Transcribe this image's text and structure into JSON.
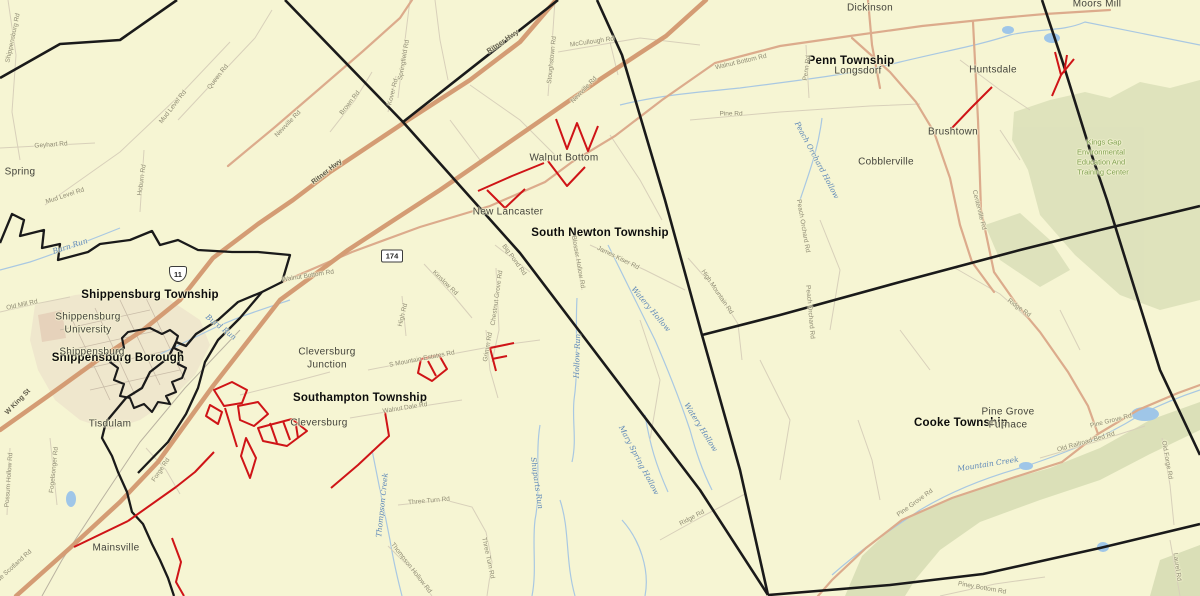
{
  "map": {
    "colors": {
      "background": "#f6f5d3",
      "boundary": "#1a1a1a",
      "highway_major": "#d49c74",
      "highway_secondary": "#dcab8c",
      "minor_road": "#d8d0ba",
      "red_highlight": "#cf1417",
      "stream": "#a9c8e2",
      "pond": "#9fc6e8",
      "forest_fill": "#dde1bb",
      "urban_fill": "#eadbc8",
      "township_text": "#0c0c0c",
      "place_text": "#44443c",
      "road_text": "#8f8b74",
      "stream_text": "#5d87b8",
      "forest_text": "#7fa053"
    }
  },
  "labels": {
    "townships": [
      {
        "t": "Shippensburg Township",
        "x": 150,
        "y": 295
      },
      {
        "t": "Shippensburg Borough",
        "x": 118,
        "y": 358
      },
      {
        "t": "Southampton Township",
        "x": 360,
        "y": 398
      },
      {
        "t": "South Newton Township",
        "x": 600,
        "y": 233
      },
      {
        "t": "Penn Township",
        "x": 851,
        "y": 61
      },
      {
        "t": "Cooke Township",
        "x": 961,
        "y": 423
      }
    ],
    "places": [
      {
        "t": "Spring",
        "x": 20,
        "y": 172
      },
      {
        "t": "Walnut Bottom",
        "x": 564,
        "y": 158
      },
      {
        "t": "New Lancaster",
        "x": 508,
        "y": 212
      },
      {
        "t": "Dickinson",
        "x": 870,
        "y": 8
      },
      {
        "t": "Longsdorf",
        "x": 858,
        "y": 71
      },
      {
        "t": "Cobblerville",
        "x": 886,
        "y": 162
      },
      {
        "t": "Moors Mill",
        "x": 1097,
        "y": 4
      },
      {
        "t": "Huntsdale",
        "x": 993,
        "y": 70
      },
      {
        "t": "Brushtown",
        "x": 953,
        "y": 132
      },
      {
        "t": "Shippensburg",
        "x": 88,
        "y": 317
      },
      {
        "t": "University",
        "x": 88,
        "y": 330
      },
      {
        "t": "Shippensburg",
        "x": 92,
        "y": 352
      },
      {
        "t": "Cleversburg",
        "x": 327,
        "y": 352
      },
      {
        "t": "Junction",
        "x": 327,
        "y": 365
      },
      {
        "t": "Cleversburg",
        "x": 319,
        "y": 423
      },
      {
        "t": "Tisdulam",
        "x": 110,
        "y": 424
      },
      {
        "t": "Mainsville",
        "x": 116,
        "y": 548
      },
      {
        "t": "Pine Grove",
        "x": 1008,
        "y": 412
      },
      {
        "t": "Furnace",
        "x": 1008,
        "y": 425
      }
    ],
    "roads": [
      {
        "t": "Shippensburg Rd",
        "x": 13,
        "y": 38,
        "r": -78
      },
      {
        "t": "Geyhart Rd",
        "x": 51,
        "y": 145,
        "r": -4
      },
      {
        "t": "Mud Level Rd",
        "x": 173,
        "y": 107,
        "r": -52
      },
      {
        "t": "Mud Level Rd",
        "x": 65,
        "y": 196,
        "r": -18
      },
      {
        "t": "Hoburn Rd",
        "x": 142,
        "y": 180,
        "r": -82
      },
      {
        "t": "Queen Rd",
        "x": 218,
        "y": 77,
        "r": -52
      },
      {
        "t": "Newville Rd",
        "x": 288,
        "y": 124,
        "r": -46
      },
      {
        "t": "Newville Rd",
        "x": 584,
        "y": 90,
        "r": -46
      },
      {
        "t": "Brown Rd",
        "x": 350,
        "y": 103,
        "r": -52
      },
      {
        "t": "Springfield Rd",
        "x": 404,
        "y": 60,
        "r": -80
      },
      {
        "t": "Kover Rd",
        "x": 393,
        "y": 92,
        "r": -76
      },
      {
        "t": "Stoughstown Rd",
        "x": 552,
        "y": 60,
        "r": -84
      },
      {
        "t": "McCullough Rd",
        "x": 592,
        "y": 42,
        "r": -8
      },
      {
        "t": "Ritner Hwy",
        "x": 503,
        "y": 42,
        "r": -34,
        "s": "dark"
      },
      {
        "t": "Ritner Hwy",
        "x": 327,
        "y": 172,
        "r": -38,
        "s": "dark"
      },
      {
        "t": "W King St",
        "x": 18,
        "y": 402,
        "r": -46,
        "s": "dark"
      },
      {
        "t": "Walnut Bottom Rd",
        "x": 741,
        "y": 62,
        "r": -13
      },
      {
        "t": "Walnut Bottom Rd",
        "x": 308,
        "y": 276,
        "r": -9
      },
      {
        "t": "Pine Rd",
        "x": 731,
        "y": 114,
        "r": 0
      },
      {
        "t": "Penn Rd",
        "x": 807,
        "y": 68,
        "r": -82
      },
      {
        "t": "Centerville Rd",
        "x": 979,
        "y": 210,
        "r": 76
      },
      {
        "t": "Peach Orchard Rd",
        "x": 803,
        "y": 226,
        "r": 80
      },
      {
        "t": "Peach Orchard Rd",
        "x": 810,
        "y": 312,
        "r": 85
      },
      {
        "t": "Ridge Rd",
        "x": 1019,
        "y": 308,
        "r": 36
      },
      {
        "t": "High Mountain Rd",
        "x": 717,
        "y": 292,
        "r": 56
      },
      {
        "t": "James Kiser Rd",
        "x": 618,
        "y": 258,
        "r": 26
      },
      {
        "t": "Blosser Hollow Rd",
        "x": 578,
        "y": 262,
        "r": 80
      },
      {
        "t": "Big Pond Rd",
        "x": 514,
        "y": 260,
        "r": 54
      },
      {
        "t": "Chestnut Grove Rd",
        "x": 497,
        "y": 298,
        "r": -82
      },
      {
        "t": "Grimm Rd",
        "x": 488,
        "y": 347,
        "r": -80
      },
      {
        "t": "Kinslow Rd",
        "x": 445,
        "y": 283,
        "r": 44
      },
      {
        "t": "High Rd",
        "x": 403,
        "y": 315,
        "r": -76
      },
      {
        "t": "S Mountain Estates Rd",
        "x": 422,
        "y": 359,
        "r": -11
      },
      {
        "t": "Walnut Dale Rd",
        "x": 405,
        "y": 408,
        "r": -9
      },
      {
        "t": "Three Turn Rd",
        "x": 429,
        "y": 501,
        "r": -5
      },
      {
        "t": "Three Turn Rd",
        "x": 488,
        "y": 558,
        "r": 78
      },
      {
        "t": "Thompson Hollow Rd",
        "x": 411,
        "y": 568,
        "r": 52
      },
      {
        "t": "Forge Rd",
        "x": 161,
        "y": 470,
        "r": -56
      },
      {
        "t": "Possum Hollow Rd",
        "x": 9,
        "y": 480,
        "r": -86
      },
      {
        "t": "Fogelsonger Rd",
        "x": 54,
        "y": 470,
        "r": -84
      },
      {
        "t": "Olde Scotland Rd",
        "x": 12,
        "y": 568,
        "r": -42
      },
      {
        "t": "Old Mill Rd",
        "x": 22,
        "y": 305,
        "r": -12
      },
      {
        "t": "Ridge Rd",
        "x": 692,
        "y": 518,
        "r": -28
      },
      {
        "t": "Pine Grove Rd",
        "x": 915,
        "y": 503,
        "r": -36
      },
      {
        "t": "Pine Grove Rd",
        "x": 1111,
        "y": 421,
        "r": -14
      },
      {
        "t": "Old Railroad Bed Rd",
        "x": 1086,
        "y": 442,
        "r": -16
      },
      {
        "t": "Old Forge Rd",
        "x": 1167,
        "y": 460,
        "r": 80
      },
      {
        "t": "Laurel Rd",
        "x": 1177,
        "y": 567,
        "r": 82
      },
      {
        "t": "Piney Bottom Rd",
        "x": 982,
        "y": 588,
        "r": 10
      }
    ],
    "streams": [
      {
        "t": "Burn Run",
        "x": 70,
        "y": 246,
        "r": -18
      },
      {
        "t": "Burd Run",
        "x": 221,
        "y": 327,
        "r": 38
      },
      {
        "t": "Peach Orchard Hollow",
        "x": 817,
        "y": 160,
        "r": 62
      },
      {
        "t": "Watery Hollow",
        "x": 651,
        "y": 309,
        "r": 50
      },
      {
        "t": "Watery Hollow",
        "x": 701,
        "y": 427,
        "r": 58
      },
      {
        "t": "Hollow Run",
        "x": 577,
        "y": 356,
        "r": -88
      },
      {
        "t": "Mary Spring Hollow",
        "x": 639,
        "y": 460,
        "r": 62
      },
      {
        "t": "Shuparts Run",
        "x": 537,
        "y": 483,
        "r": 82
      },
      {
        "t": "Thompson Creek",
        "x": 382,
        "y": 505,
        "r": -84
      },
      {
        "t": "Mountain Creek",
        "x": 988,
        "y": 464,
        "r": -9
      }
    ],
    "forest": [
      {
        "t": "Kings Gap",
        "x": 1104,
        "y": 142
      },
      {
        "t": "Environmental",
        "x": 1101,
        "y": 152
      },
      {
        "t": "Education And",
        "x": 1101,
        "y": 162
      },
      {
        "t": "Training Center",
        "x": 1103,
        "y": 172
      }
    ],
    "shields": [
      {
        "kind": "us",
        "t": "11",
        "x": 178,
        "y": 274
      },
      {
        "kind": "pa",
        "t": "174",
        "x": 392,
        "y": 256
      }
    ]
  }
}
